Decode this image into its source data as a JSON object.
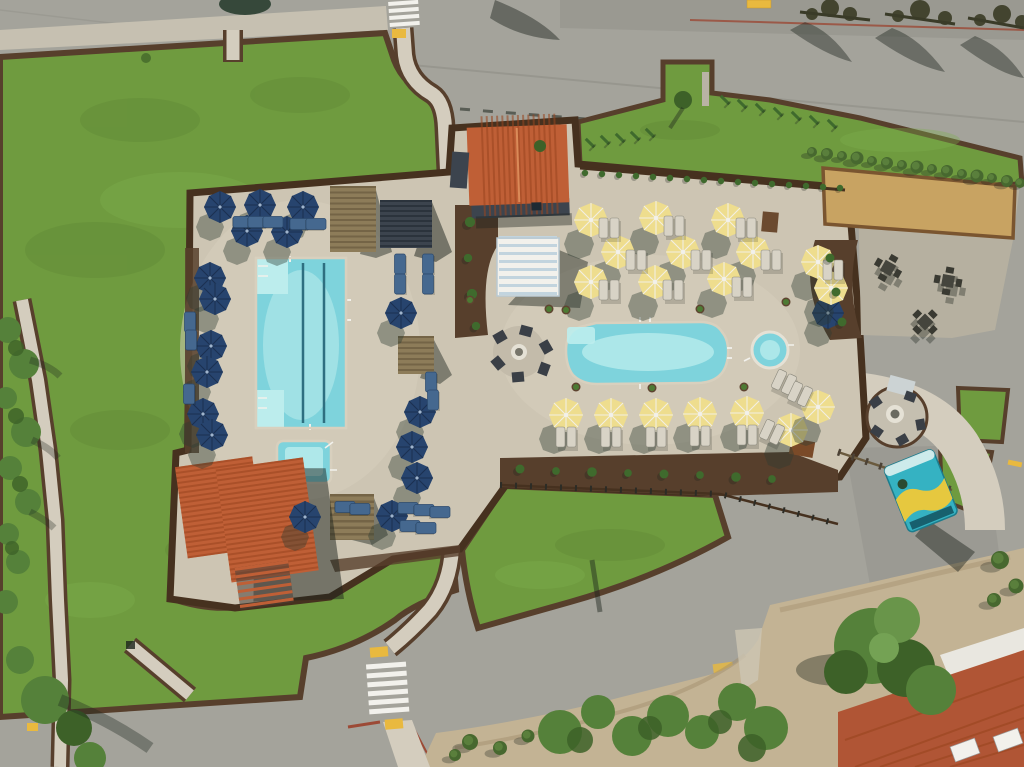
{
  "meta": {
    "title": "Aerial drone view of resort pool complex",
    "description": "Overhead aerial photograph of a resort amenity area: a rectangular lap pool with lane lines surrounded by navy blue umbrellas, a free-form leisure pool and round spa surrounded by yellow umbrellas and gray loungers, terracotta-roofed pool buildings, a striped cabana, pergolas, a bocce ball court, a gravel patio with picnic tables, a gas fire pit circle, a teal food truck, winding concrete paths, large green lawns with dark mulch borders, and perimeter roads with white crosswalks."
  },
  "colors": {
    "base-road": "#a4a39b",
    "road-seam": "#8f8f87",
    "sidewalk": "#c6c0b1",
    "lawn": "#6f9b3f",
    "lawn-light": "#7fae4c",
    "lawn-dark": "#597f31",
    "mulch": "#573f2c",
    "mulch-dark": "#46311f",
    "deck": "#cdc5b3",
    "deck-light": "#d8d0be",
    "path": "#d4cdbe",
    "gravel": "#b6b0a0",
    "sand": "#c3b394",
    "sand-dark": "#a3906e",
    "court-sand": "#c8a362",
    "court-rim": "#7a5530",
    "pool-water": "#7ed3dc",
    "pool-light": "#bceded",
    "pool-line": "#2e6f80",
    "navy": "#27446e",
    "navy-dark": "#1b3050",
    "umb-yellow": "#eedd8e",
    "umb-shadow": "#2e3b33",
    "white": "#f2f1ec",
    "roof-orange": "#bf5f36",
    "roof-line": "#99451f",
    "roof-red": "#b05535",
    "wood": "#8d7c59",
    "wood-dark": "#6a5a3e",
    "dark-struct": "#3c444e",
    "blue-lounge": "#45688f",
    "gray-lounge": "#d8d3c6",
    "truck-teal": "#35b2c2",
    "truck-yellow": "#e6c83f",
    "fire-ring": "#e5e1d5",
    "plant-green": "#3f6a2d",
    "tree-green": "#55813a",
    "tree-dark": "#3d6128",
    "hedge": "#47682f",
    "scrub": "#7d8c66",
    "red-curb": "#9c4a36",
    "yellow-mark": "#e9b93f",
    "shadow": "#1d241d"
  },
  "scene": {
    "inventory": {
      "lap_pool": 1,
      "freeform_pool": 1,
      "square_spa": 1,
      "round_spa": 1,
      "yellow_umbrellas": 18,
      "navy_umbrellas": 18,
      "pool_buildings": 2,
      "cabanas": 1,
      "pergolas": 4,
      "bocce_court": 1,
      "picnic_tables": 3,
      "fire_pits": 2,
      "food_trucks": 1,
      "crosswalks": 2
    }
  },
  "sprites": [
    {
      "s": "umb-n",
      "x": 220,
      "y": 207,
      "n": "navy-umbrella"
    },
    {
      "s": "umb-n",
      "x": 260,
      "y": 205,
      "n": "navy-umbrella"
    },
    {
      "s": "umb-n",
      "x": 303,
      "y": 207,
      "n": "navy-umbrella"
    },
    {
      "s": "umb-n",
      "x": 247,
      "y": 231,
      "n": "navy-umbrella"
    },
    {
      "s": "umb-n",
      "x": 287,
      "y": 232,
      "n": "navy-umbrella"
    },
    {
      "s": "umb-n",
      "x": 210,
      "y": 278,
      "n": "navy-umbrella"
    },
    {
      "s": "umb-n",
      "x": 215,
      "y": 299,
      "n": "navy-umbrella"
    },
    {
      "s": "umb-n",
      "x": 211,
      "y": 346,
      "n": "navy-umbrella"
    },
    {
      "s": "umb-n",
      "x": 207,
      "y": 372,
      "n": "navy-umbrella"
    },
    {
      "s": "umb-n",
      "x": 203,
      "y": 414,
      "n": "navy-umbrella"
    },
    {
      "s": "umb-n",
      "x": 212,
      "y": 435,
      "n": "navy-umbrella"
    },
    {
      "s": "umb-n",
      "x": 401,
      "y": 313,
      "n": "navy-umbrella"
    },
    {
      "s": "umb-n",
      "x": 420,
      "y": 412,
      "n": "navy-umbrella"
    },
    {
      "s": "umb-n",
      "x": 412,
      "y": 447,
      "n": "navy-umbrella"
    },
    {
      "s": "umb-n",
      "x": 417,
      "y": 478,
      "n": "navy-umbrella"
    },
    {
      "s": "umb-n",
      "x": 305,
      "y": 517,
      "n": "navy-umbrella"
    },
    {
      "s": "umb-n",
      "x": 392,
      "y": 516,
      "n": "navy-umbrella"
    },
    {
      "s": "umb-n",
      "x": 828,
      "y": 313,
      "n": "navy-umbrella"
    },
    {
      "s": "umb-y",
      "x": 591,
      "y": 220,
      "n": "yellow-umbrella"
    },
    {
      "s": "umb-y",
      "x": 656,
      "y": 218,
      "n": "yellow-umbrella"
    },
    {
      "s": "umb-y",
      "x": 728,
      "y": 220,
      "n": "yellow-umbrella"
    },
    {
      "s": "umb-y",
      "x": 618,
      "y": 252,
      "n": "yellow-umbrella"
    },
    {
      "s": "umb-y",
      "x": 683,
      "y": 252,
      "n": "yellow-umbrella"
    },
    {
      "s": "umb-y",
      "x": 753,
      "y": 252,
      "n": "yellow-umbrella"
    },
    {
      "s": "umb-y",
      "x": 591,
      "y": 282,
      "n": "yellow-umbrella"
    },
    {
      "s": "umb-y",
      "x": 655,
      "y": 282,
      "n": "yellow-umbrella"
    },
    {
      "s": "umb-y",
      "x": 724,
      "y": 279,
      "n": "yellow-umbrella"
    },
    {
      "s": "umb-y",
      "x": 818,
      "y": 262,
      "n": "yellow-umbrella"
    },
    {
      "s": "umb-y",
      "x": 831,
      "y": 288,
      "n": "yellow-umbrella"
    },
    {
      "s": "umb-y",
      "x": 566,
      "y": 415,
      "n": "yellow-umbrella"
    },
    {
      "s": "umb-y",
      "x": 611,
      "y": 415,
      "n": "yellow-umbrella"
    },
    {
      "s": "umb-y",
      "x": 656,
      "y": 415,
      "n": "yellow-umbrella"
    },
    {
      "s": "umb-y",
      "x": 700,
      "y": 414,
      "n": "yellow-umbrella"
    },
    {
      "s": "umb-y",
      "x": 747,
      "y": 413,
      "n": "yellow-umbrella"
    },
    {
      "s": "umb-y",
      "x": 791,
      "y": 430,
      "n": "yellow-umbrella"
    },
    {
      "s": "umb-y",
      "x": 818,
      "y": 407,
      "n": "yellow-umbrella"
    },
    {
      "s": "lounge-g",
      "x": 609,
      "y": 228,
      "n": "lounger-pair"
    },
    {
      "s": "lounge-g",
      "x": 674,
      "y": 226,
      "n": "lounger-pair"
    },
    {
      "s": "lounge-g",
      "x": 746,
      "y": 228,
      "n": "lounger-pair"
    },
    {
      "s": "lounge-g",
      "x": 636,
      "y": 260,
      "n": "lounger-pair"
    },
    {
      "s": "lounge-g",
      "x": 701,
      "y": 260,
      "n": "lounger-pair"
    },
    {
      "s": "lounge-g",
      "x": 771,
      "y": 260,
      "n": "lounger-pair"
    },
    {
      "s": "lounge-g",
      "x": 609,
      "y": 290,
      "n": "lounger-pair"
    },
    {
      "s": "lounge-g",
      "x": 673,
      "y": 290,
      "n": "lounger-pair"
    },
    {
      "s": "lounge-g",
      "x": 742,
      "y": 287,
      "n": "lounger-pair"
    },
    {
      "s": "lounge-g",
      "x": 833,
      "y": 270,
      "n": "lounger-pair"
    },
    {
      "s": "lounge-g",
      "x": 566,
      "y": 437,
      "n": "lounger-pair"
    },
    {
      "s": "lounge-g",
      "x": 611,
      "y": 437,
      "n": "lounger-pair"
    },
    {
      "s": "lounge-g",
      "x": 656,
      "y": 437,
      "n": "lounger-pair"
    },
    {
      "s": "lounge-g",
      "x": 700,
      "y": 436,
      "n": "lounger-pair"
    },
    {
      "s": "lounge-g",
      "x": 747,
      "y": 435,
      "n": "lounger-pair"
    },
    {
      "s": "lounge-g",
      "x": 784,
      "y": 382,
      "r": 25,
      "n": "lounger-pair"
    },
    {
      "s": "lounge-g",
      "x": 800,
      "y": 394,
      "r": 25,
      "n": "lounger-pair"
    },
    {
      "s": "lounge-g",
      "x": 772,
      "y": 432,
      "r": 25,
      "n": "lounger-pair"
    },
    {
      "s": "lounge-b",
      "x": 243,
      "y": 222,
      "r": 90,
      "n": "blue-lounger"
    },
    {
      "s": "lounge-b",
      "x": 258,
      "y": 222,
      "r": 90,
      "n": "blue-lounger"
    },
    {
      "s": "lounge-b",
      "x": 273,
      "y": 222,
      "r": 90,
      "n": "blue-lounger"
    },
    {
      "s": "lounge-b",
      "x": 300,
      "y": 224,
      "r": 90,
      "n": "blue-lounger"
    },
    {
      "s": "lounge-b",
      "x": 316,
      "y": 224,
      "r": 90,
      "n": "blue-lounger"
    },
    {
      "s": "lounge-b",
      "x": 400,
      "y": 264,
      "n": "blue-lounger"
    },
    {
      "s": "lounge-b",
      "x": 400,
      "y": 284,
      "n": "blue-lounger"
    },
    {
      "s": "lounge-b",
      "x": 428,
      "y": 264,
      "n": "blue-lounger"
    },
    {
      "s": "lounge-b",
      "x": 428,
      "y": 284,
      "n": "blue-lounger"
    },
    {
      "s": "lounge-b",
      "x": 431,
      "y": 382,
      "n": "blue-lounger"
    },
    {
      "s": "lounge-b",
      "x": 433,
      "y": 400,
      "n": "blue-lounger"
    },
    {
      "s": "lounge-b",
      "x": 408,
      "y": 508,
      "r": 90,
      "n": "blue-lounger"
    },
    {
      "s": "lounge-b",
      "x": 424,
      "y": 510,
      "r": 90,
      "n": "blue-lounger"
    },
    {
      "s": "lounge-b",
      "x": 440,
      "y": 512,
      "r": 90,
      "n": "blue-lounger"
    },
    {
      "s": "lounge-b",
      "x": 410,
      "y": 526,
      "r": 90,
      "n": "blue-lounger"
    },
    {
      "s": "lounge-b",
      "x": 426,
      "y": 528,
      "r": 90,
      "n": "blue-lounger"
    },
    {
      "s": "lounge-b",
      "x": 190,
      "y": 322,
      "n": "blue-lounger"
    },
    {
      "s": "lounge-b",
      "x": 191,
      "y": 340,
      "n": "blue-lounger"
    },
    {
      "s": "lounge-b",
      "x": 189,
      "y": 394,
      "n": "blue-lounger"
    },
    {
      "s": "lounge-b",
      "x": 345,
      "y": 507,
      "r": 90,
      "n": "blue-lounger"
    },
    {
      "s": "lounge-b",
      "x": 360,
      "y": 509,
      "r": 90,
      "n": "blue-lounger"
    },
    {
      "s": "picnic",
      "x": 888,
      "y": 268,
      "r": 30,
      "n": "picnic-table"
    },
    {
      "s": "picnic",
      "x": 948,
      "y": 281,
      "r": 10,
      "n": "picnic-table"
    },
    {
      "s": "picnic",
      "x": 925,
      "y": 322,
      "r": 45,
      "n": "picnic-table"
    },
    {
      "s": "bush",
      "x": 812,
      "y": 152,
      "n": "hedge-bush"
    },
    {
      "s": "bush",
      "x": 827,
      "y": 154,
      "k": 1.2,
      "n": "hedge-bush"
    },
    {
      "s": "bush",
      "x": 842,
      "y": 156,
      "n": "hedge-bush"
    },
    {
      "s": "bush",
      "x": 857,
      "y": 158,
      "k": 1.3,
      "n": "hedge-bush"
    },
    {
      "s": "bush",
      "x": 872,
      "y": 161,
      "n": "hedge-bush"
    },
    {
      "s": "bush",
      "x": 887,
      "y": 163,
      "k": 1.2,
      "n": "hedge-bush"
    },
    {
      "s": "bush",
      "x": 902,
      "y": 165,
      "n": "hedge-bush"
    },
    {
      "s": "bush",
      "x": 917,
      "y": 167,
      "k": 1.3,
      "n": "hedge-bush"
    },
    {
      "s": "bush",
      "x": 932,
      "y": 169,
      "n": "hedge-bush"
    },
    {
      "s": "bush",
      "x": 947,
      "y": 171,
      "k": 1.2,
      "n": "hedge-bush"
    },
    {
      "s": "bush",
      "x": 962,
      "y": 174,
      "n": "hedge-bush"
    },
    {
      "s": "bush",
      "x": 977,
      "y": 176,
      "k": 1.3,
      "n": "hedge-bush"
    },
    {
      "s": "bush",
      "x": 992,
      "y": 178,
      "n": "hedge-bush"
    },
    {
      "s": "bush",
      "x": 1007,
      "y": 181,
      "k": 1.2,
      "n": "hedge-bush"
    },
    {
      "s": "bush",
      "x": 1020,
      "y": 183,
      "n": "hedge-bush"
    },
    {
      "s": "plantS",
      "x": 585,
      "y": 173,
      "n": "fence-plant"
    },
    {
      "s": "plantS",
      "x": 602,
      "y": 174,
      "n": "fence-plant"
    },
    {
      "s": "plantS",
      "x": 619,
      "y": 175,
      "n": "fence-plant"
    },
    {
      "s": "plantS",
      "x": 636,
      "y": 176,
      "n": "fence-plant"
    },
    {
      "s": "plantS",
      "x": 653,
      "y": 177,
      "n": "fence-plant"
    },
    {
      "s": "plantS",
      "x": 670,
      "y": 178,
      "n": "fence-plant"
    },
    {
      "s": "plantS",
      "x": 687,
      "y": 179,
      "n": "fence-plant"
    },
    {
      "s": "plantS",
      "x": 704,
      "y": 180,
      "n": "fence-plant"
    },
    {
      "s": "plantS",
      "x": 721,
      "y": 181,
      "n": "fence-plant"
    },
    {
      "s": "plantS",
      "x": 738,
      "y": 182,
      "n": "fence-plant"
    },
    {
      "s": "plantS",
      "x": 755,
      "y": 183,
      "n": "fence-plant"
    },
    {
      "s": "plantS",
      "x": 772,
      "y": 184,
      "n": "fence-plant"
    },
    {
      "s": "plantS",
      "x": 789,
      "y": 185,
      "n": "fence-plant"
    },
    {
      "s": "plantS",
      "x": 806,
      "y": 186,
      "n": "fence-plant"
    },
    {
      "s": "plantS",
      "x": 823,
      "y": 187,
      "n": "fence-plant"
    },
    {
      "s": "plantS",
      "x": 840,
      "y": 188,
      "n": "fence-plant"
    },
    {
      "s": "vine",
      "x": 590,
      "y": 143,
      "r": -45,
      "n": "vine-plant"
    },
    {
      "s": "vine",
      "x": 605,
      "y": 140,
      "r": -45,
      "n": "vine-plant"
    },
    {
      "s": "vine",
      "x": 620,
      "y": 138,
      "r": -45,
      "n": "vine-plant"
    },
    {
      "s": "vine",
      "x": 635,
      "y": 136,
      "r": -45,
      "n": "vine-plant"
    },
    {
      "s": "vine",
      "x": 650,
      "y": 133,
      "r": -45,
      "n": "vine-plant"
    },
    {
      "s": "vine",
      "x": 725,
      "y": 100,
      "r": -45,
      "n": "vine-plant"
    },
    {
      "s": "vine",
      "x": 742,
      "y": 104,
      "r": -45,
      "n": "vine-plant"
    },
    {
      "s": "vine",
      "x": 760,
      "y": 108,
      "r": -45,
      "n": "vine-plant"
    },
    {
      "s": "vine",
      "x": 778,
      "y": 112,
      "r": -45,
      "n": "vine-plant"
    },
    {
      "s": "vine",
      "x": 796,
      "y": 116,
      "r": -45,
      "n": "vine-plant"
    },
    {
      "s": "vine",
      "x": 814,
      "y": 120,
      "r": -45,
      "n": "vine-plant"
    },
    {
      "s": "vine",
      "x": 832,
      "y": 124,
      "r": -45,
      "n": "vine-plant"
    },
    {
      "s": "plantS",
      "x": 520,
      "y": 469,
      "k": 1.4,
      "n": "bed-plant"
    },
    {
      "s": "plantS",
      "x": 556,
      "y": 471,
      "k": 1.2,
      "n": "bed-plant"
    },
    {
      "s": "plantS",
      "x": 592,
      "y": 472,
      "k": 1.5,
      "n": "bed-plant"
    },
    {
      "s": "plantS",
      "x": 628,
      "y": 473,
      "k": 1.2,
      "n": "bed-plant"
    },
    {
      "s": "plantS",
      "x": 664,
      "y": 474,
      "k": 1.4,
      "n": "bed-plant"
    },
    {
      "s": "plantS",
      "x": 700,
      "y": 475,
      "k": 1.2,
      "n": "bed-plant"
    },
    {
      "s": "plantS",
      "x": 736,
      "y": 477,
      "k": 1.5,
      "n": "bed-plant"
    },
    {
      "s": "plantS",
      "x": 772,
      "y": 479,
      "k": 1.2,
      "n": "bed-plant"
    },
    {
      "s": "plantS",
      "x": 470,
      "y": 222,
      "k": 1.6,
      "n": "bed-plant"
    },
    {
      "s": "plantS",
      "x": 468,
      "y": 258,
      "k": 1.3,
      "n": "bed-plant"
    },
    {
      "s": "plantS",
      "x": 472,
      "y": 294,
      "k": 1.6,
      "n": "bed-plant"
    },
    {
      "s": "plantS",
      "x": 476,
      "y": 326,
      "k": 1.3,
      "n": "bed-plant"
    },
    {
      "s": "plantS",
      "x": 830,
      "y": 258,
      "k": 1.4,
      "n": "bed-plant"
    },
    {
      "s": "plantS",
      "x": 836,
      "y": 292,
      "k": 1.4,
      "n": "bed-plant"
    },
    {
      "s": "plantS",
      "x": 842,
      "y": 322,
      "k": 1.4,
      "n": "bed-plant"
    },
    {
      "s": "planter",
      "x": 470,
      "y": 300,
      "n": "planter-pot"
    },
    {
      "s": "planter",
      "x": 549,
      "y": 309,
      "n": "planter-pot"
    },
    {
      "s": "planter",
      "x": 576,
      "y": 387,
      "n": "planter-pot"
    },
    {
      "s": "planter",
      "x": 652,
      "y": 388,
      "n": "planter-pot"
    },
    {
      "s": "planter",
      "x": 700,
      "y": 309,
      "n": "planter-pot"
    },
    {
      "s": "planter",
      "x": 744,
      "y": 387,
      "n": "planter-pot"
    },
    {
      "s": "planter",
      "x": 566,
      "y": 310,
      "n": "planter-pot"
    },
    {
      "s": "planter",
      "x": 786,
      "y": 302,
      "n": "planter-pot"
    },
    {
      "s": "bush",
      "x": 470,
      "y": 742,
      "k": 1.6,
      "n": "scrub-bush"
    },
    {
      "s": "bush",
      "x": 500,
      "y": 748,
      "k": 1.4,
      "n": "scrub-bush"
    },
    {
      "s": "bush",
      "x": 528,
      "y": 736,
      "k": 1.3,
      "n": "scrub-bush"
    },
    {
      "s": "bush",
      "x": 455,
      "y": 755,
      "k": 1.2,
      "n": "scrub-bush"
    },
    {
      "s": "bush",
      "x": 1000,
      "y": 560,
      "k": 1.8,
      "n": "roadside-tree"
    },
    {
      "s": "bush",
      "x": 1016,
      "y": 586,
      "k": 1.5,
      "n": "roadside-tree"
    },
    {
      "s": "bush",
      "x": 994,
      "y": 600,
      "k": 1.4,
      "n": "roadside-tree"
    }
  ]
}
